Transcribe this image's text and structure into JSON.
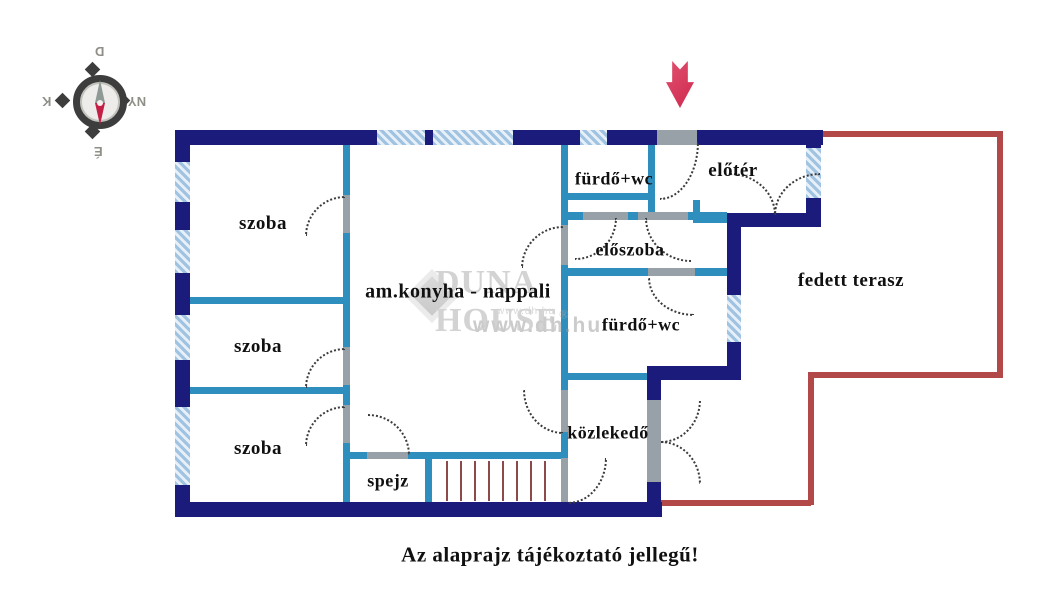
{
  "caption": "Az alaprajz tájékoztató jellegű!",
  "compass": {
    "top": "D",
    "left": "K",
    "right": "NY",
    "bottom": "É"
  },
  "watermark": {
    "brand": "DUNA HOUSE",
    "registered": "®",
    "url_small": "www.dh.hu",
    "url_large": "www.dh.hu"
  },
  "rooms": [
    {
      "label": "szoba"
    },
    {
      "label": "szoba"
    },
    {
      "label": "szoba"
    },
    {
      "label": "am.konyha - nappali"
    },
    {
      "label": "spejz"
    },
    {
      "label": "fürdő+wc"
    },
    {
      "label": "előtér"
    },
    {
      "label": "előszoba"
    },
    {
      "label": "fürdő+wc"
    },
    {
      "label": "közlekedő"
    },
    {
      "label": "fedett terasz"
    }
  ],
  "colors": {
    "wall": "#1b1b7c",
    "partition": "#2e8fbe",
    "window_fill": "#bcd6ec",
    "terrace": "#b24848",
    "arrow": "#cf2950",
    "stairs": "#8d4a4a"
  }
}
